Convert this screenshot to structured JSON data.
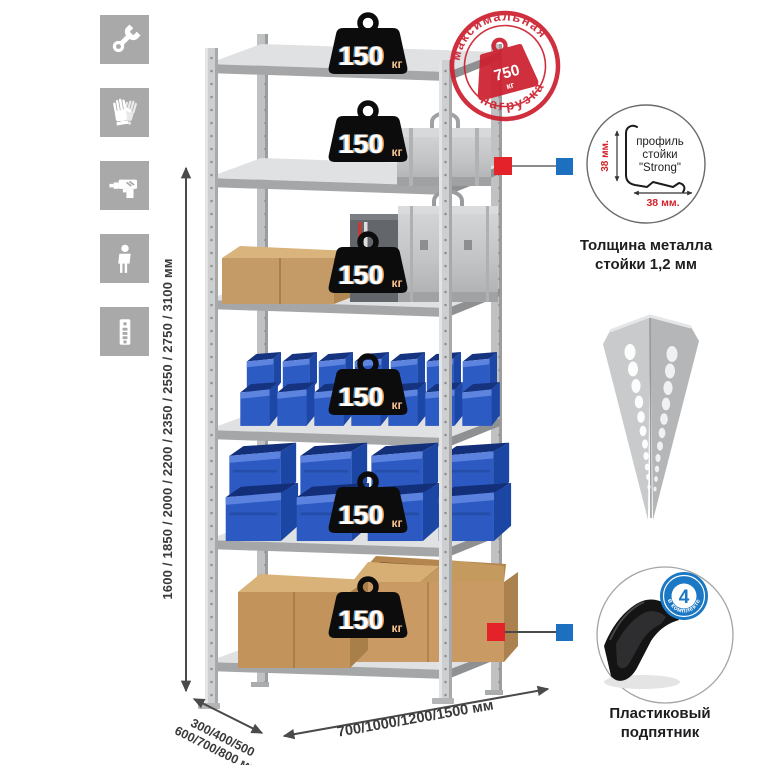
{
  "assembly_icons": [
    {
      "name": "wrench-icon"
    },
    {
      "name": "gloves-icon"
    },
    {
      "name": "drill-icon"
    },
    {
      "name": "person-icon"
    },
    {
      "name": "perforated-profile-icon"
    }
  ],
  "dimensions": {
    "height_label": "1600 / 1850 / 2000 / 2200 / 2350 / 2550 / 2750 / 3100 мм",
    "depth_line1": "300/400/500",
    "depth_line2": "600/700/800 мм",
    "width_label": "700/1000/1200/1500 мм"
  },
  "shelf_load_badge": {
    "value": "150",
    "unit": "кг",
    "count": 6
  },
  "max_load_stamp": {
    "arc_top": "максимальная",
    "arc_bottom": "нагрузка",
    "value": "750",
    "unit": "кг"
  },
  "profile_detail": {
    "vertical_dim": "38 мм.",
    "horizontal_dim": "38 мм.",
    "label_line1": "профиль",
    "label_line2": "стойки",
    "label_line3": "\"Strong\"",
    "caption_line1": "Толщина металла",
    "caption_line2": "стойки 1,2 мм"
  },
  "foot_detail": {
    "badge_value": "4",
    "badge_arc_text": "в комплекте",
    "caption_line1": "Пластиковый",
    "caption_line2": "подпятник"
  },
  "colors": {
    "stamp_red": "#cd2130",
    "connector_red": "#e32229",
    "connector_blue": "#1d6fc0",
    "bin_blue": "#2d5bc4",
    "badge_black": "#0c0c0c",
    "metal_gray": "#c7c9cb",
    "icon_gray": "#a9a9a9"
  }
}
